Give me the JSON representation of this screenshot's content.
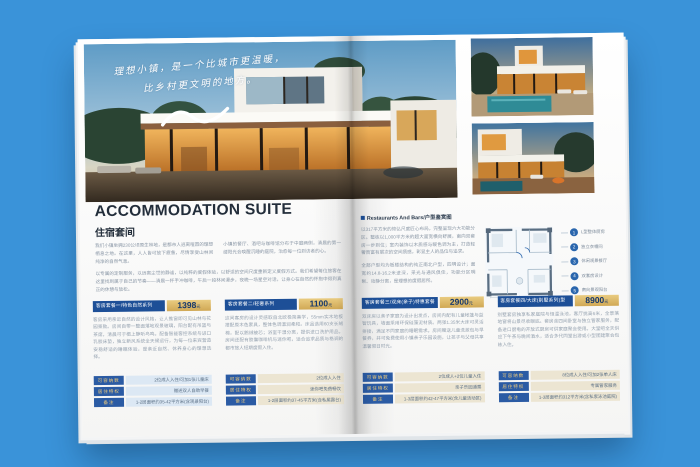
{
  "background_color": "#3a93d9",
  "accent_colors": {
    "band_blue": "#1d4f97",
    "badge_gold": "#d9b365",
    "table_label_blue": "#2b5ba4",
    "table_value_beige": "#ece5d2",
    "table_value_blue": "#dce8f4"
  },
  "brochure": {
    "hero": {
      "handwriting_line1": "理想小镇，是一个比城市更温暖，",
      "handwriting_line2": "比乡村更文明的地方。"
    },
    "left_page": {
      "title_en": "ACCOMMODATION SUITE",
      "title_cn": "住宿套间",
      "intro_col1": "我们小镇坐拥230公顷原生林地，是都市人逃离喧嚣的理想栖息之地。在这里，人人皆可放下疲惫，尽情享受山林间纯净的自然气息。",
      "intro_col2": "小镇的餐厅、酒吧与咖啡馆分布于中庭两侧，清晨的第一缕阳光会唤醒沉睡的庭院，治愈每一位到访者的心。",
      "intro_full": "以专属的定制服务，以远离尘世的静谧，以纯粹的度假体验，以舒适的空间尺度重新定义度假方式。我们希望每位旅客在这里找到属于自己的节奏——清晨一杯手冲咖啡，午后一段林间漫步，夜晚一场星空对话，让身心在自然的怀抱中得到真正的休憩与放松。",
      "packages": [
        {
          "name": "客房套餐一/特色自然系列",
          "price": "1398",
          "unit": "元",
          "desc": "客房采用亲近自然的设计风格，让人推窗即可见山林与花园景致。房间自带一整面落地观景玻璃，阳台配有吊篮与茶席，清晨可于榻上静听鸟鸣。配备智能客控系统与进口乳胶床垫，独立新风系统全天候运行，为每一位来宾营造安稳舒适的睡眠体验，是亲近自然、休养身心的理想选择。",
          "rows": [
            {
              "label": "可容纳数",
              "value": "2位成人入住/可加1张儿童床"
            },
            {
              "label": "居住特权",
              "value": "赠送双人自助早餐"
            },
            {
              "label": "备注",
              "value": "1-2层面积约35-42平方米(含观景阳台)"
            }
          ]
        },
        {
          "name": "客房套餐二/轻奢系列",
          "price": "1100",
          "unit": "元",
          "desc": "这间客房的设计灵感取自北欧极简美学，55mm实木地板搭配原木色家具，整体色调温润柔和。床品选用60支长绒棉，配以鹅绒被芯；浴室干湿分离，提供进口洗护用品。房间还配有胶囊咖啡机与迷你吧，适合追求品质与格调的都市旅人短期度假入住。",
          "rows": [
            {
              "label": "可容纳数",
              "value": "2位成人入住"
            },
            {
              "label": "居住特权",
              "value": "迷你吧免费畅饮"
            },
            {
              "label": "备注",
              "value": "1-2层面积约37-45平方米(含私属露台)"
            }
          ]
        }
      ]
    },
    "right_page": {
      "section_title": "Restaurants And Bars/户型鉴赏图",
      "para1": "以317平方米的恢弘尺度匠心布局，完整呈现六大功能分区。整栋以1,000平方米的超大面宽横向舒展，南向双套房一步到位；室内装饰以木质感与暖色调为主，打造轻奢而富有层次的空间质感，彰显主人的品位与追求。",
      "para2": "全部户型均为板楼结构的纯正南北户型，四明设计；面宽约14.8-16.2米进深，采光与通风俱佳，功能分区明晰、动静分离，是理想的度假居所。",
      "legend": [
        {
          "num": "1",
          "label": "L型整体厨房"
        },
        {
          "num": "2",
          "label": "独立衣帽间"
        },
        {
          "num": "3",
          "label": "休闲观景餐厅"
        },
        {
          "num": "4",
          "label": "双套房设计"
        },
        {
          "num": "5",
          "label": "南向景观阳台"
        }
      ],
      "packages": [
        {
          "name": "客房套餐三/双床(亲子)特惠套餐",
          "price": "2900",
          "unit": "元",
          "desc": "双床房以亲子家庭为设计出发点，房间内配有儿童帐篷与益智玩具，墙面采用环保硅藻泥材质。两张1.35米大床可灵活拼接，满足不同家庭的睡眠需求。房间赠送儿童洗漱包与早餐券，并可免费使用小镇亲子乐园设施，让孩子与父母共享温馨假日时光。",
          "rows": [
            {
              "label": "可容纳数",
              "value": "2位成人+2位儿童入住"
            },
            {
              "label": "居住特权",
              "value": "亲子乐园通票"
            },
            {
              "label": "备注",
              "value": "1-3层面积约42-47平方米(含儿童活动区)"
            }
          ]
        },
        {
          "name": "客房套餐四/大床(别墅系列)型",
          "price": "8900",
          "unit": "元",
          "desc": "别墅套房独享私家庭院与恒温泳池，客厅挑高6米，全景落地窗将山景尽收眼底。套房含四间卧室与独立管家服务，配备进口厨电的开放式厨房可供家庭聚会使用。大堂吧全天供应下午茶与晚间酒水，适合多代同堂出游或小型团建聚会包栋入住。",
          "rows": [
            {
              "label": "可容纳数",
              "value": "8位成人入住/可加2张单人床"
            },
            {
              "label": "居住特权",
              "value": "专属管家服务"
            },
            {
              "label": "备注",
              "value": "1-3层面积约312平方米(含私家泳池庭院)"
            }
          ]
        }
      ]
    }
  }
}
